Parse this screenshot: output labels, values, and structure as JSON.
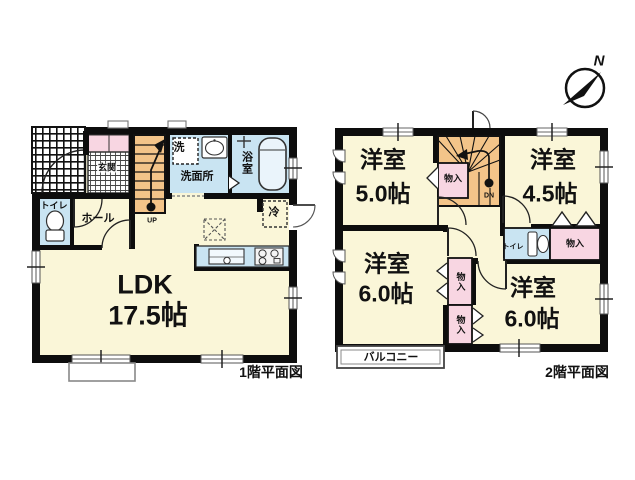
{
  "colors": {
    "room": "#faf6d8",
    "stairs": "#f3c489",
    "water": "#c9e4f2",
    "closet": "#f8d6e2",
    "wall": "#0d0d0d"
  },
  "compass": {
    "north_label": "N"
  },
  "floor1": {
    "title": "1階平面図",
    "ldk_name": "LDK",
    "ldk_area": "17.5帖",
    "genkan": "玄関",
    "toilet": "トイレ",
    "hall": "ホール",
    "washer": "洗",
    "washroom": "洗面所",
    "bath": "浴室",
    "fridge": "冷",
    "stairs": "UP"
  },
  "floor2": {
    "title": "2階平面図",
    "rooms": [
      {
        "name": "洋室",
        "area": "5.0帖"
      },
      {
        "name": "洋室",
        "area": "4.5帖"
      },
      {
        "name": "洋室",
        "area": "6.0帖"
      },
      {
        "name": "洋室",
        "area": "6.0帖"
      }
    ],
    "closet": "物入",
    "toilet": "トイレ",
    "balcony": "バルコニー",
    "stairs": "DN"
  }
}
